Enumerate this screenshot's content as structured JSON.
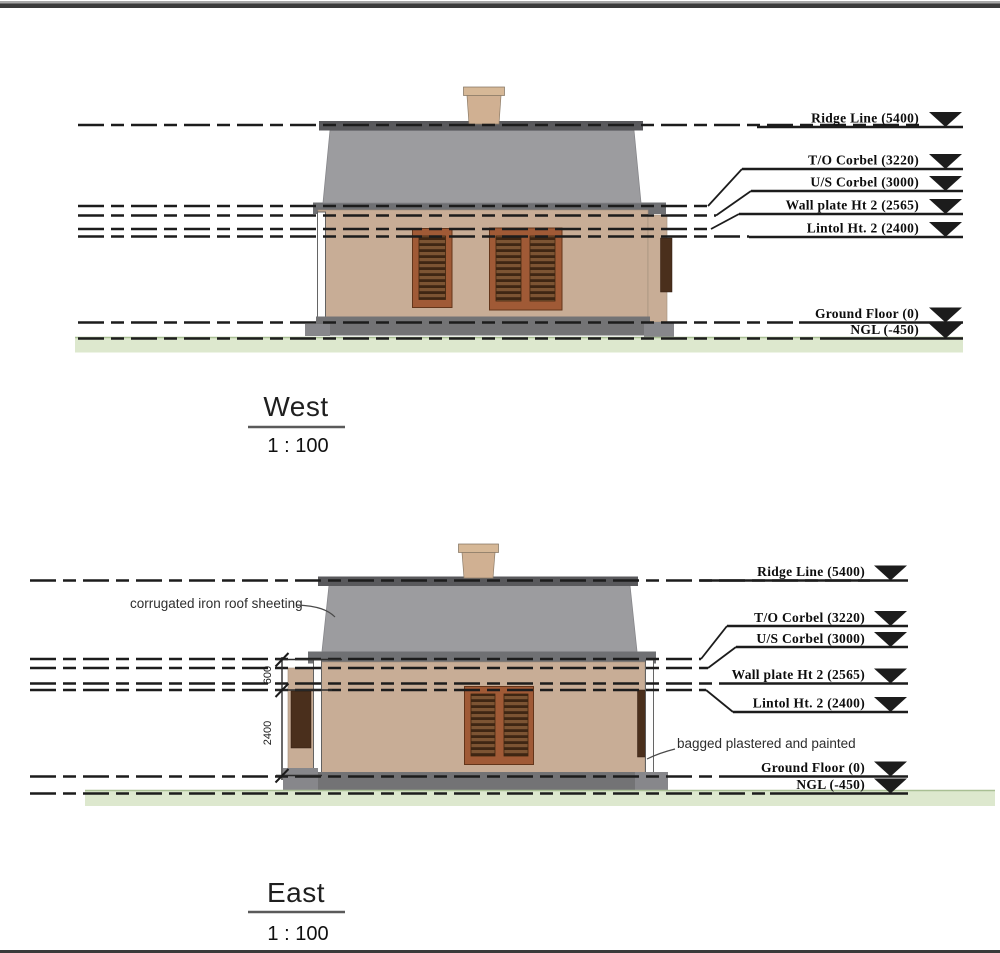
{
  "colors": {
    "line": "#1c1c1c",
    "roof": "#9c9c9f",
    "ridge_cap": "#59595c",
    "eaves": "#6f7073",
    "wall": "#c8ad96",
    "plinth": "#737375",
    "chimney": "#d0b092",
    "chimney_cap": "#d6b897",
    "window_frame": "#a05a36",
    "shutter": "#4a2f1c",
    "ground_band": "#dde8ce",
    "ground_edge": "#a9bf94"
  },
  "west": {
    "title": "West",
    "scale": "1 : 100",
    "levels": [
      {
        "name": "Ridge Line",
        "value": "5400",
        "label": "Ridge Line (5400)"
      },
      {
        "name": "T/O Corbel",
        "value": "3220",
        "label": "T/O Corbel (3220)"
      },
      {
        "name": "U/S Corbel",
        "value": "3000",
        "label": "U/S Corbel (3000)"
      },
      {
        "name": "Wall plate Ht 2",
        "value": "2565",
        "label": "Wall plate Ht 2 (2565)"
      },
      {
        "name": "Lintol Ht. 2",
        "value": "2400",
        "label": "Lintol Ht. 2 (2400)"
      },
      {
        "name": "Ground Floor",
        "value": "0",
        "label": "Ground Floor (0)"
      },
      {
        "name": "NGL",
        "value": "-450",
        "label": "NGL (-450)"
      }
    ]
  },
  "east": {
    "title": "East",
    "scale": "1 : 100",
    "levels": [
      {
        "name": "Ridge Line",
        "value": "5400",
        "label": "Ridge Line (5400)"
      },
      {
        "name": "T/O Corbel",
        "value": "3220",
        "label": "T/O Corbel (3220)"
      },
      {
        "name": "U/S Corbel",
        "value": "3000",
        "label": "U/S Corbel (3000)"
      },
      {
        "name": "Wall plate Ht 2",
        "value": "2565",
        "label": "Wall plate Ht 2 (2565)"
      },
      {
        "name": "Lintol Ht. 2",
        "value": "2400",
        "label": "Lintol Ht. 2 (2400)"
      },
      {
        "name": "Ground Floor",
        "value": "0",
        "label": "Ground Floor (0)"
      },
      {
        "name": "NGL",
        "value": "-450",
        "label": "NGL (-450)"
      }
    ],
    "notes": {
      "roof": "corrugated iron roof sheeting",
      "wall": "bagged plastered and painted"
    },
    "dimensions": {
      "upper": "600",
      "lower": "2400"
    }
  }
}
